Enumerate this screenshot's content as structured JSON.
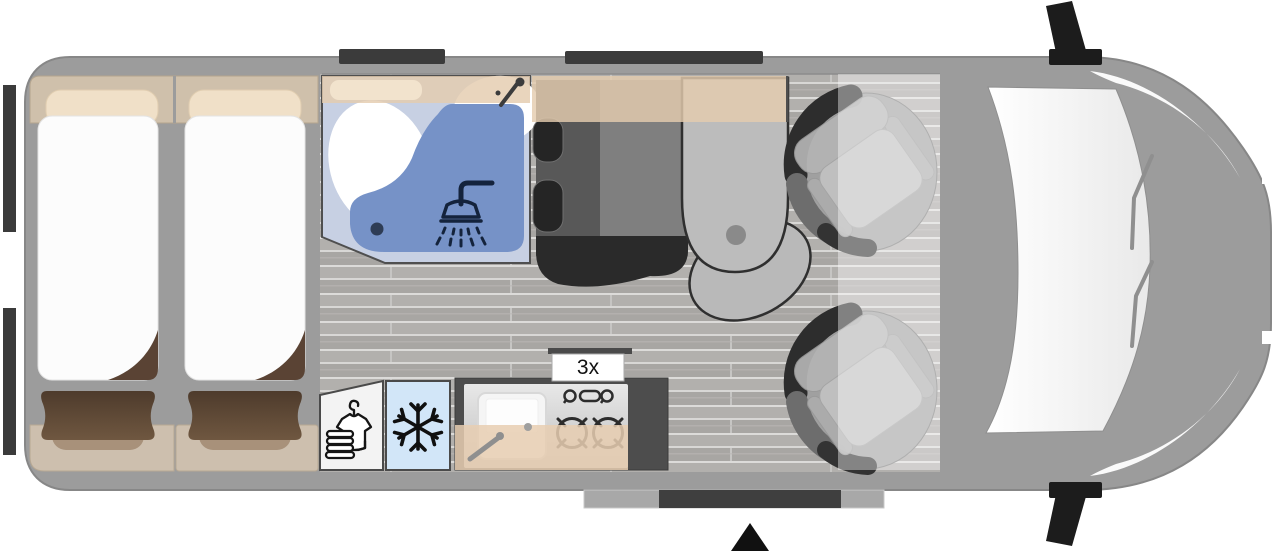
{
  "diagram": {
    "kind": "campervan-floorplan-top-view",
    "labels": {
      "stove_count": "3x"
    },
    "icons": {
      "shower": "shower-head-icon",
      "bath_faucet": "faucet-icon",
      "fridge": "snowflake-icon",
      "wardrobe": "shirt-hanger-towels-icon",
      "entrance": "entry-arrow-icon",
      "burners": "gas-burner-icon",
      "mirrors": "wing-mirror-icon"
    },
    "colors": {
      "body_gray": "#9c9c9c",
      "body_outline": "#878787",
      "floor_gray": "#aeacaa",
      "bathroom_floor": "#c7d0e3",
      "shower_blue": "#7692c7",
      "fridge_blue": "#d2e6f8",
      "cabinet_beige": "#cfc0ab",
      "overhead_beige": "rgba(228,204,174,0.82)",
      "bench_beige": "#cdbfae",
      "pillow_beige": "#f0e0c8",
      "cushion_brown": "#54402f",
      "mattress_white": "#fcfcfc",
      "counter_dark": "#4d4d4d",
      "seat_dark": "#585858",
      "seat_darker": "#2a2a2a",
      "table_gray": "#bcbcbc",
      "window_dark": "#3b3b3b",
      "icon_navy": "#14233c",
      "icon_black": "#151515",
      "step_gray": "#a8a8a8",
      "wardrobe_white": "#f3f3f3",
      "windshield_white": "#f8f8f8"
    }
  }
}
